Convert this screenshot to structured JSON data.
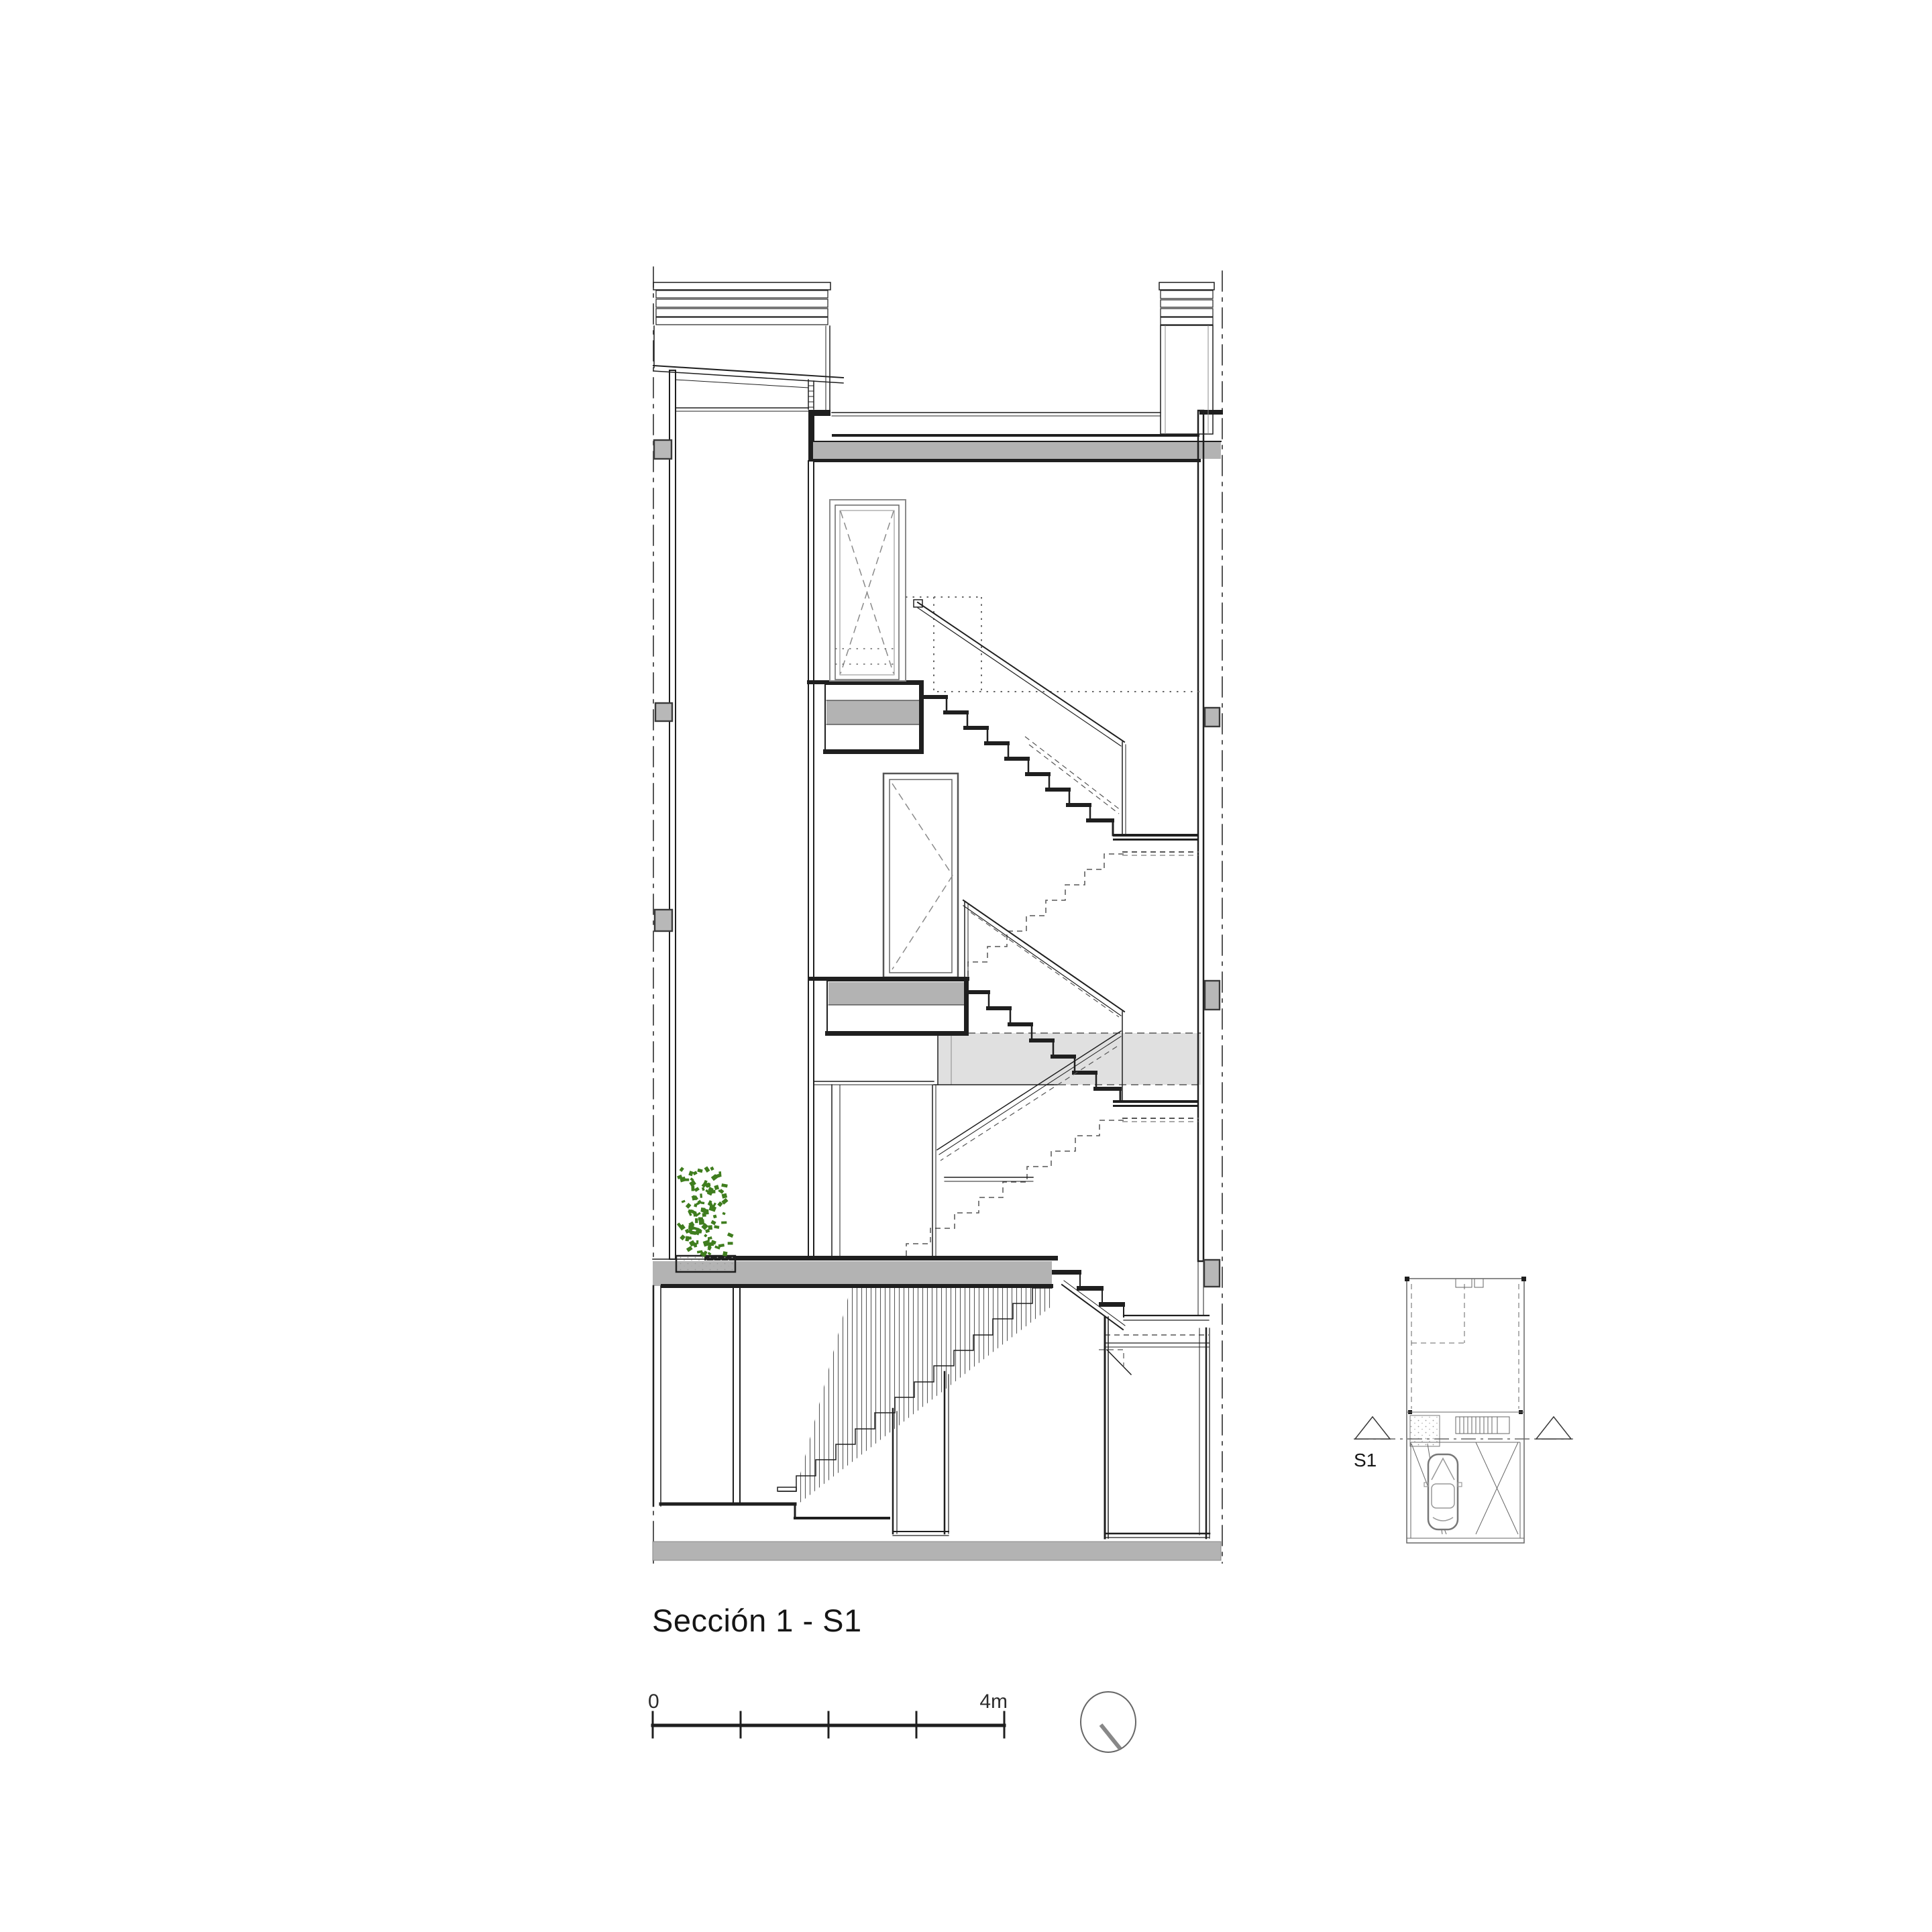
{
  "drawing": {
    "title": "Sección 1 - S1",
    "scale_bar": {
      "start_label": "0",
      "end_label": "4m"
    },
    "key_plan": {
      "section_label": "S1"
    }
  },
  "icons": {
    "north_indicator": "north-circle-with-needle",
    "section_cut_arrows": "triangle-markers",
    "plant": "green-foliage-scatter"
  },
  "colors": {
    "line": "#1f1f1f",
    "slab_gray": "#b3b3b3",
    "light_gray": "#e0e0e0",
    "neighbor_gray": "#b8b8b8",
    "plant_green": "#3f7d1e",
    "frame_gray": "#8a8a8a"
  }
}
